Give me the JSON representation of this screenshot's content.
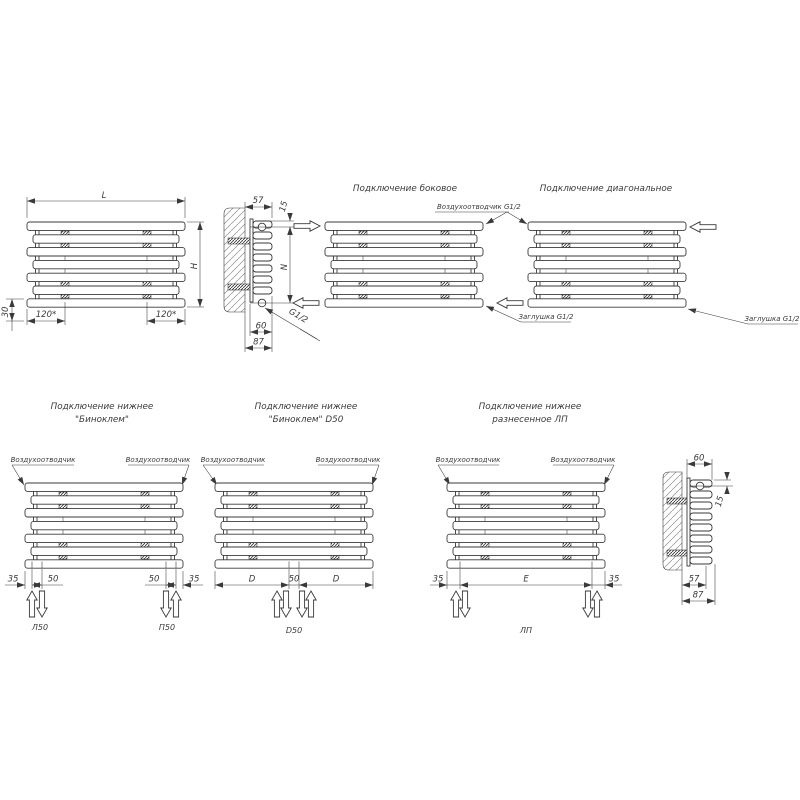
{
  "meta": {
    "background": "#ffffff",
    "line_color": "#3a3a3a"
  },
  "front_view": {
    "length": "L",
    "height": "H",
    "bracket_left": "120*",
    "bracket_right": "120*",
    "bottom_offset": "30"
  },
  "side_top": {
    "depth": "57",
    "top_offset": "15",
    "axis_span": "N",
    "depth_inner": "60",
    "depth_total": "87",
    "thread": "G1/2"
  },
  "side_bottom": {
    "depth_inner": "60",
    "top_offset": "15",
    "depth": "57",
    "depth_total": "87"
  },
  "titles": {
    "side": "Подключение боковое",
    "diagonal": "Подключение диагональное",
    "b1a": "Подключение нижнее",
    "b1b": "\"Биноклем\"",
    "b2a": "Подключение нижнее",
    "b2b": "\"Биноклем\" D50",
    "b3a": "Подключение нижнее",
    "b3b": "разнесенное ЛП"
  },
  "callouts": {
    "air_vent_g12": "Воздухоотводчик G1/2",
    "plug_left": "Заглушка G1/2",
    "plug_right": "Заглушка G1/2",
    "air_vent": "Воздухоотводчик"
  },
  "b1": {
    "d35l": "35",
    "d50l": "50",
    "d50r": "50",
    "d35r": "35",
    "tag_left": "Л50",
    "tag_right": "П50"
  },
  "b2": {
    "dl": "D",
    "d50": "50",
    "dr": "D",
    "tag": "D50"
  },
  "b3": {
    "d35l": "35",
    "de": "E",
    "d35r": "35",
    "tag": "ЛП"
  }
}
